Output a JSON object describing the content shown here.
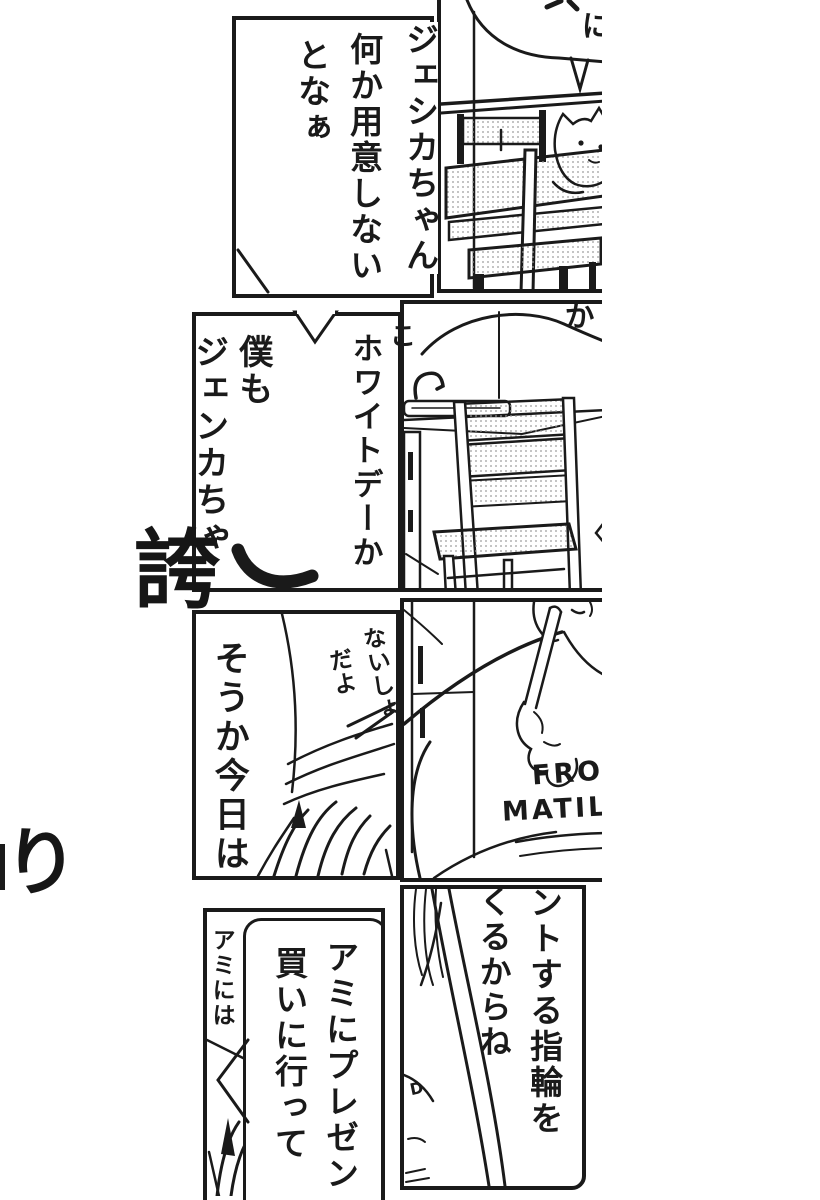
{
  "colors": {
    "ink": "#1a1a1a",
    "paper": "#ffffff"
  },
  "p1": {
    "l1": "ジェシカちゃん",
    "l2": "何か用意しない",
    "l3": "となぁ"
  },
  "p2": {
    "fragment": "に"
  },
  "p3": {
    "l1": "ホワイトデーか",
    "l2": "僕も",
    "l3": "ジェンカちゃ",
    "edge_fragment": "こ"
  },
  "p4": {
    "fragment": "か"
  },
  "p5": {
    "dialogue": "そうか今日は",
    "whisper1": "ないしょ",
    "whisper2": "だよ"
  },
  "p6": {
    "shirt1": "FRO",
    "shirt2": "MATIL"
  },
  "p7": {
    "side_text": "アミには",
    "bubble1": "アミにプレゼン",
    "bubble2": "買いに行って"
  },
  "p8": {
    "bubble1": "ントする指輪を",
    "bubble2": "くるからね",
    "shirt_fragment": "D"
  },
  "decor": {
    "glyph1": "誇",
    "glyph2": "り"
  }
}
